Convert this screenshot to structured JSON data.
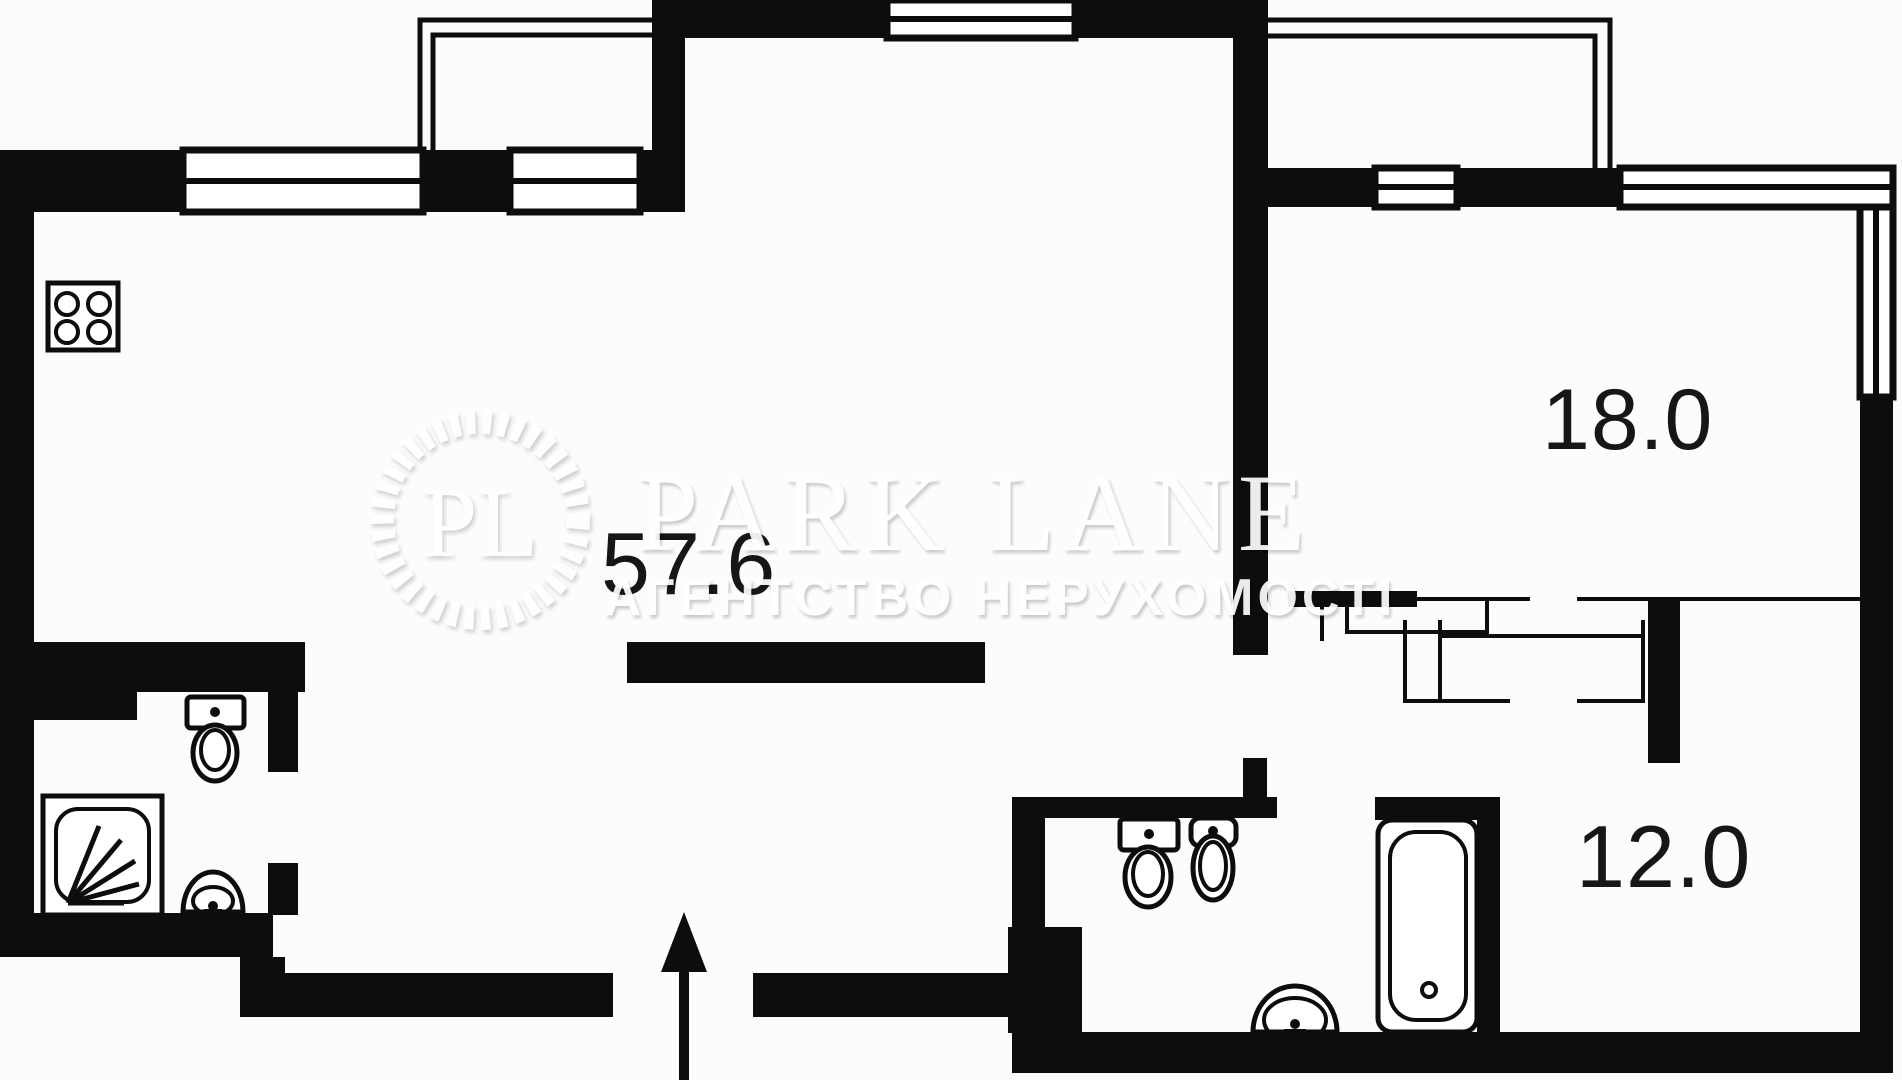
{
  "watermark": {
    "badge_initials": "PL",
    "brand": "PARK LANE",
    "tagline": "АГЕНТСТВО НЕРУХОМОСТІ"
  },
  "rooms": [
    {
      "name": "living-room-kitchen",
      "area_label": "57.6"
    },
    {
      "name": "bedroom-top-right",
      "area_label": "18.0"
    },
    {
      "name": "room-bottom-right",
      "area_label": "12.0"
    }
  ],
  "fixtures": [
    "stove-icon",
    "toilet-icon",
    "shower-icon",
    "sink-icon",
    "toilet-icon",
    "bidet-icon",
    "bathtub-icon",
    "sink-icon",
    "entrance-arrow-icon"
  ],
  "colors": {
    "walls": "#0d0d0d",
    "background": "#fcfcfc",
    "area_labels": "#161616"
  }
}
